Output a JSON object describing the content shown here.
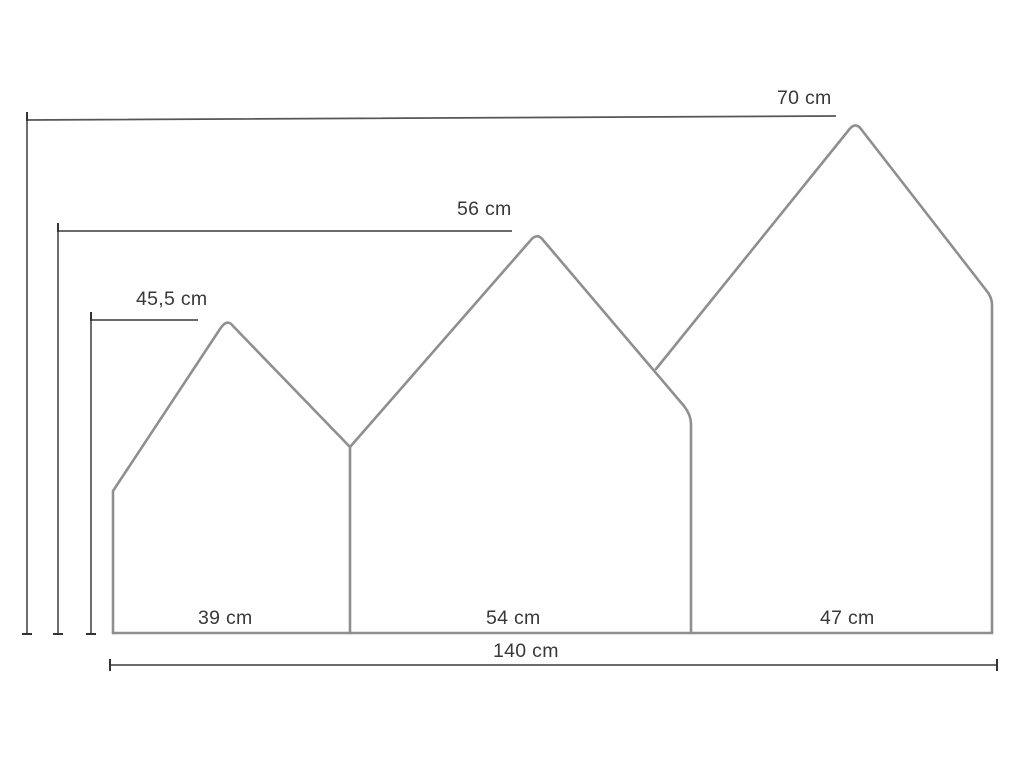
{
  "figure": {
    "type": "dimension-drawing",
    "unit": "cm",
    "background_color": "#ffffff",
    "panel_outline_color": "#8f8f8f",
    "dimension_line_color": "#565656",
    "tick_color": "#333333",
    "text_color": "#383838",
    "panels": [
      {
        "position": "left",
        "width_cm": 39,
        "height_cm": 45.5
      },
      {
        "position": "middle",
        "width_cm": 54,
        "height_cm": 56
      },
      {
        "position": "right",
        "width_cm": 47,
        "height_cm": 70
      }
    ],
    "total_width_cm": 140,
    "labels": {
      "height_left": "45,5 cm",
      "height_middle": "56 cm",
      "height_right": "70 cm",
      "width_left": "39 cm",
      "width_middle": "54 cm",
      "width_right": "47 cm",
      "total_width": "140 cm"
    }
  }
}
